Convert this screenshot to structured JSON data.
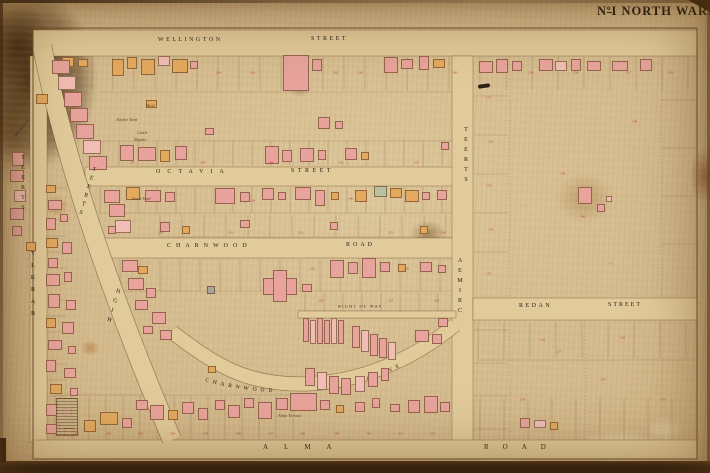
{
  "title": {
    "no": "N",
    "sup": "o",
    "rest": "I NORTH WARD"
  },
  "grove_label": {
    "part1": "CHARNWOOD",
    "part2": "GROVE"
  },
  "palette": {
    "building_pink": "#e8a49c",
    "building_pink_light": "#f0beb4",
    "building_orange": "#e3a95f",
    "building_green": "#b9c1a3",
    "building_grey": "#aaa596",
    "street_fill": "#e2cb9b",
    "paper": "#d3b98c",
    "lot_number_red": "#b5473e",
    "ink": "#2a2016"
  },
  "street_labels": [
    {
      "t": "WELLINGTON",
      "x": 158,
      "y": 37,
      "fs": 6,
      "ls": 2.5,
      "cls": "h"
    },
    {
      "t": "STREET",
      "x": 311,
      "y": 36,
      "fs": 6,
      "ls": 2.5,
      "cls": "h"
    },
    {
      "t": "OCTAVIA",
      "x": 156,
      "y": 169,
      "fs": 6,
      "ls": 7,
      "cls": "h"
    },
    {
      "t": "STREET",
      "x": 291,
      "y": 168,
      "fs": 6,
      "ls": 3.5,
      "cls": "h"
    },
    {
      "t": "CHARNWOOD",
      "x": 167,
      "y": 243,
      "fs": 6,
      "ls": 5,
      "cls": "h"
    },
    {
      "t": "ROAD",
      "x": 346,
      "y": 242,
      "fs": 6,
      "ls": 3,
      "cls": "h"
    },
    {
      "t": "REDAN",
      "x": 519,
      "y": 303,
      "fs": 6,
      "ls": 2.5,
      "cls": "h"
    },
    {
      "t": "STREET",
      "x": 608,
      "y": 302,
      "fs": 6,
      "ls": 2,
      "cls": "h"
    },
    {
      "t": "ALMA",
      "x": 263,
      "y": 444,
      "fs": 7,
      "ls": 16,
      "cls": "h"
    },
    {
      "t": "ROAD",
      "x": 484,
      "y": 444,
      "fs": 7,
      "ls": 14,
      "cls": "h"
    },
    {
      "t": "RIGHT OF WAY",
      "x": 338,
      "y": 305,
      "fs": 6,
      "ls": 2,
      "cls": "h",
      "sc": 0.68
    },
    {
      "t": "NELSON ST",
      "x": 14,
      "y": 136,
      "fs": 6,
      "ls": 0.5,
      "cls": "h",
      "rot": -52,
      "sc": 0.6
    },
    {
      "t": "BARKLY",
      "x": 33,
      "y": 287,
      "fs": 6,
      "ls": 6,
      "cls": "v",
      "up": true
    },
    {
      "t": "STREET",
      "x": 23,
      "y": 185,
      "fs": 6,
      "ls": 4,
      "cls": "v",
      "up": true
    },
    {
      "t": "CRIMEA",
      "x": 460,
      "y": 288,
      "fs": 6,
      "ls": 4,
      "cls": "v",
      "up": true
    },
    {
      "t": "STREET",
      "x": 466,
      "y": 157,
      "fs": 6,
      "ls": 4,
      "cls": "v",
      "up": true
    },
    {
      "t": "HIGH",
      "x": 113,
      "y": 308,
      "fs": 6,
      "ls": 4,
      "cls": "v",
      "up": true,
      "rot": 17
    },
    {
      "t": "STREET",
      "x": 87,
      "y": 193,
      "fs": 6,
      "ls": 3,
      "cls": "v",
      "up": true,
      "rot": 17
    }
  ],
  "cursive_labels": [
    {
      "t": "Shed",
      "x": 146,
      "y": 104
    },
    {
      "t": "Timber Yard",
      "x": 116,
      "y": 118
    },
    {
      "t": "Cattle",
      "x": 137,
      "y": 131
    },
    {
      "t": "Market",
      "x": 134,
      "y": 138
    },
    {
      "t": "Stock Yard",
      "x": 132,
      "y": 197
    },
    {
      "t": "Alma Terrace",
      "x": 278,
      "y": 414
    }
  ],
  "lot_numbers": [
    {
      "t": "264",
      "x": 216,
      "y": 71
    },
    {
      "t": "263",
      "x": 250,
      "y": 71
    },
    {
      "t": "262",
      "x": 333,
      "y": 71
    },
    {
      "t": "261",
      "x": 358,
      "y": 71
    },
    {
      "t": "260",
      "x": 452,
      "y": 71
    },
    {
      "t": "259",
      "x": 528,
      "y": 71
    },
    {
      "t": "258",
      "x": 573,
      "y": 71
    },
    {
      "t": "257",
      "x": 626,
      "y": 71
    },
    {
      "t": "256",
      "x": 668,
      "y": 71
    },
    {
      "t": "151",
      "x": 486,
      "y": 96
    },
    {
      "t": "152",
      "x": 488,
      "y": 140
    },
    {
      "t": "153",
      "x": 486,
      "y": 184
    },
    {
      "t": "154",
      "x": 488,
      "y": 228
    },
    {
      "t": "155",
      "x": 486,
      "y": 272
    },
    {
      "t": "150",
      "x": 560,
      "y": 172
    },
    {
      "t": "149",
      "x": 632,
      "y": 120
    },
    {
      "t": "166",
      "x": 580,
      "y": 215
    },
    {
      "t": "171",
      "x": 608,
      "y": 262
    },
    {
      "t": "247",
      "x": 130,
      "y": 161
    },
    {
      "t": "248",
      "x": 200,
      "y": 161
    },
    {
      "t": "249",
      "x": 268,
      "y": 161
    },
    {
      "t": "250",
      "x": 338,
      "y": 161
    },
    {
      "t": "251",
      "x": 414,
      "y": 161
    },
    {
      "t": "239",
      "x": 250,
      "y": 199
    },
    {
      "t": "240",
      "x": 348,
      "y": 197
    },
    {
      "t": "230",
      "x": 158,
      "y": 231
    },
    {
      "t": "231",
      "x": 228,
      "y": 231
    },
    {
      "t": "232",
      "x": 298,
      "y": 231
    },
    {
      "t": "233",
      "x": 388,
      "y": 231
    },
    {
      "t": "234",
      "x": 440,
      "y": 231
    },
    {
      "t": "225",
      "x": 310,
      "y": 267
    },
    {
      "t": "226",
      "x": 404,
      "y": 267
    },
    {
      "t": "218",
      "x": 318,
      "y": 299
    },
    {
      "t": "219",
      "x": 388,
      "y": 299
    },
    {
      "t": "220",
      "x": 434,
      "y": 299
    },
    {
      "t": "301",
      "x": 74,
      "y": 432
    },
    {
      "t": "302",
      "x": 106,
      "y": 432
    },
    {
      "t": "303",
      "x": 138,
      "y": 432
    },
    {
      "t": "304",
      "x": 170,
      "y": 432
    },
    {
      "t": "305",
      "x": 203,
      "y": 432
    },
    {
      "t": "306",
      "x": 236,
      "y": 432
    },
    {
      "t": "307",
      "x": 268,
      "y": 432
    },
    {
      "t": "308",
      "x": 300,
      "y": 432
    },
    {
      "t": "309",
      "x": 334,
      "y": 432
    },
    {
      "t": "310",
      "x": 366,
      "y": 432
    },
    {
      "t": "311",
      "x": 398,
      "y": 432
    },
    {
      "t": "312",
      "x": 430,
      "y": 432
    },
    {
      "t": "156",
      "x": 520,
      "y": 398
    },
    {
      "t": "157",
      "x": 556,
      "y": 350
    },
    {
      "t": "158",
      "x": 600,
      "y": 378
    },
    {
      "t": "159",
      "x": 660,
      "y": 398
    },
    {
      "t": "161",
      "x": 540,
      "y": 338
    },
    {
      "t": "162",
      "x": 620,
      "y": 336
    }
  ],
  "buildings": [
    [
      36,
      94,
      12,
      10,
      "o"
    ],
    [
      62,
      57,
      12,
      10,
      "o"
    ],
    [
      78,
      59,
      10,
      8,
      "o"
    ],
    [
      112,
      59,
      12,
      17,
      "o"
    ],
    [
      127,
      57,
      10,
      12,
      "o"
    ],
    [
      141,
      59,
      14,
      16,
      "o"
    ],
    [
      158,
      56,
      12,
      10,
      "P"
    ],
    [
      172,
      59,
      16,
      14,
      "o"
    ],
    [
      190,
      61,
      8,
      8,
      "p"
    ],
    [
      283,
      55,
      26,
      36,
      "p"
    ],
    [
      312,
      59,
      10,
      12,
      "p"
    ],
    [
      384,
      57,
      14,
      16,
      "p"
    ],
    [
      401,
      59,
      12,
      10,
      "p"
    ],
    [
      419,
      56,
      10,
      14,
      "p"
    ],
    [
      433,
      59,
      12,
      9,
      "o"
    ],
    [
      479,
      61,
      14,
      12,
      "p"
    ],
    [
      496,
      59,
      12,
      14,
      "p"
    ],
    [
      512,
      61,
      10,
      10,
      "p"
    ],
    [
      539,
      59,
      14,
      12,
      "p"
    ],
    [
      555,
      61,
      12,
      10,
      "P"
    ],
    [
      571,
      59,
      10,
      12,
      "p"
    ],
    [
      587,
      61,
      14,
      10,
      "p"
    ],
    [
      612,
      61,
      16,
      10,
      "p"
    ],
    [
      640,
      59,
      12,
      12,
      "p"
    ],
    [
      146,
      100,
      11,
      8,
      "o"
    ],
    [
      318,
      117,
      12,
      12,
      "p"
    ],
    [
      335,
      121,
      8,
      8,
      "p"
    ],
    [
      205,
      128,
      9,
      7,
      "p"
    ],
    [
      52,
      60,
      18,
      14,
      "p"
    ],
    [
      58,
      76,
      18,
      14,
      "P"
    ],
    [
      64,
      92,
      18,
      15,
      "p"
    ],
    [
      70,
      108,
      18,
      14,
      "p"
    ],
    [
      76,
      124,
      18,
      15,
      "p"
    ],
    [
      83,
      140,
      18,
      14,
      "P"
    ],
    [
      89,
      156,
      18,
      14,
      "p"
    ],
    [
      104,
      190,
      16,
      13,
      "p"
    ],
    [
      109,
      204,
      16,
      13,
      "p"
    ],
    [
      115,
      220,
      16,
      13,
      "P"
    ],
    [
      12,
      152,
      12,
      14,
      "p"
    ],
    [
      10,
      170,
      14,
      12,
      "p"
    ],
    [
      14,
      190,
      12,
      12,
      "P"
    ],
    [
      10,
      208,
      14,
      12,
      "p"
    ],
    [
      12,
      226,
      10,
      10,
      "p"
    ],
    [
      26,
      242,
      10,
      9,
      "o"
    ],
    [
      46,
      185,
      10,
      8,
      "o"
    ],
    [
      48,
      200,
      14,
      10,
      "p"
    ],
    [
      46,
      218,
      10,
      12,
      "p"
    ],
    [
      60,
      214,
      8,
      8,
      "p"
    ],
    [
      46,
      238,
      12,
      10,
      "o"
    ],
    [
      62,
      242,
      10,
      12,
      "p"
    ],
    [
      48,
      258,
      10,
      10,
      "p"
    ],
    [
      46,
      274,
      14,
      12,
      "p"
    ],
    [
      64,
      272,
      8,
      10,
      "p"
    ],
    [
      48,
      294,
      12,
      14,
      "p"
    ],
    [
      66,
      300,
      10,
      10,
      "p"
    ],
    [
      46,
      318,
      10,
      10,
      "o"
    ],
    [
      62,
      322,
      12,
      12,
      "p"
    ],
    [
      48,
      340,
      14,
      10,
      "p"
    ],
    [
      68,
      346,
      8,
      8,
      "p"
    ],
    [
      46,
      360,
      10,
      12,
      "p"
    ],
    [
      64,
      368,
      12,
      10,
      "p"
    ],
    [
      50,
      384,
      12,
      10,
      "o"
    ],
    [
      70,
      388,
      8,
      8,
      "p"
    ],
    [
      46,
      404,
      12,
      12,
      "p"
    ],
    [
      62,
      408,
      10,
      8,
      "p"
    ],
    [
      46,
      424,
      14,
      10,
      "p"
    ],
    [
      64,
      428,
      10,
      8,
      "o"
    ],
    [
      120,
      145,
      14,
      16,
      "p"
    ],
    [
      138,
      147,
      18,
      14,
      "p"
    ],
    [
      160,
      150,
      10,
      12,
      "o"
    ],
    [
      175,
      146,
      12,
      14,
      "p"
    ],
    [
      265,
      146,
      14,
      18,
      "p"
    ],
    [
      282,
      150,
      10,
      12,
      "p"
    ],
    [
      300,
      148,
      14,
      14,
      "p"
    ],
    [
      318,
      150,
      8,
      10,
      "p"
    ],
    [
      345,
      148,
      12,
      12,
      "p"
    ],
    [
      361,
      152,
      8,
      8,
      "o"
    ],
    [
      126,
      187,
      14,
      13,
      "o"
    ],
    [
      145,
      190,
      16,
      12,
      "p"
    ],
    [
      165,
      192,
      10,
      10,
      "p"
    ],
    [
      215,
      188,
      20,
      16,
      "p"
    ],
    [
      240,
      192,
      10,
      10,
      "p"
    ],
    [
      262,
      188,
      12,
      12,
      "p"
    ],
    [
      278,
      192,
      8,
      8,
      "p"
    ],
    [
      295,
      187,
      16,
      13,
      "p"
    ],
    [
      315,
      190,
      10,
      16,
      "p"
    ],
    [
      331,
      192,
      8,
      8,
      "o"
    ],
    [
      355,
      190,
      12,
      12,
      "o"
    ],
    [
      374,
      186,
      13,
      11,
      "gn"
    ],
    [
      390,
      188,
      12,
      10,
      "o"
    ],
    [
      405,
      190,
      14,
      12,
      "o"
    ],
    [
      422,
      192,
      8,
      8,
      "p"
    ],
    [
      437,
      190,
      10,
      10,
      "p"
    ],
    [
      160,
      222,
      10,
      10,
      "p"
    ],
    [
      182,
      226,
      8,
      8,
      "o"
    ],
    [
      240,
      220,
      10,
      8,
      "p"
    ],
    [
      330,
      222,
      8,
      8,
      "p"
    ],
    [
      420,
      226,
      8,
      8,
      "o"
    ],
    [
      108,
      226,
      8,
      8,
      "p"
    ],
    [
      207,
      286,
      8,
      8,
      "g"
    ],
    [
      441,
      142,
      8,
      8,
      "p"
    ],
    [
      122,
      260,
      16,
      12,
      "p"
    ],
    [
      138,
      266,
      10,
      8,
      "o"
    ],
    [
      128,
      278,
      16,
      12,
      "p"
    ],
    [
      146,
      288,
      10,
      10,
      "p"
    ],
    [
      135,
      300,
      13,
      10,
      "p"
    ],
    [
      152,
      312,
      14,
      12,
      "p"
    ],
    [
      143,
      326,
      10,
      8,
      "p"
    ],
    [
      160,
      330,
      12,
      10,
      "p"
    ],
    [
      330,
      260,
      14,
      18,
      "p"
    ],
    [
      348,
      262,
      10,
      12,
      "p"
    ],
    [
      362,
      258,
      14,
      20,
      "p"
    ],
    [
      380,
      262,
      10,
      10,
      "p"
    ],
    [
      398,
      264,
      8,
      8,
      "o"
    ],
    [
      420,
      262,
      12,
      10,
      "p"
    ],
    [
      438,
      265,
      8,
      8,
      "p"
    ],
    [
      302,
      284,
      10,
      8,
      "p"
    ],
    [
      263,
      278,
      34,
      17,
      "p"
    ],
    [
      273,
      270,
      14,
      32,
      "p"
    ],
    [
      303,
      318,
      6,
      24,
      "p"
    ],
    [
      310,
      320,
      6,
      24,
      "P"
    ],
    [
      317,
      318,
      6,
      26,
      "p"
    ],
    [
      324,
      320,
      6,
      24,
      "p"
    ],
    [
      331,
      318,
      6,
      26,
      "P"
    ],
    [
      338,
      320,
      6,
      24,
      "p"
    ],
    [
      352,
      326,
      8,
      22,
      "p"
    ],
    [
      361,
      330,
      8,
      22,
      "P"
    ],
    [
      370,
      334,
      8,
      22,
      "p"
    ],
    [
      379,
      338,
      8,
      20,
      "p"
    ],
    [
      388,
      342,
      8,
      18,
      "P"
    ],
    [
      415,
      330,
      14,
      12,
      "p"
    ],
    [
      432,
      334,
      10,
      10,
      "p"
    ],
    [
      438,
      318,
      10,
      9,
      "p"
    ],
    [
      305,
      368,
      10,
      18,
      "p"
    ],
    [
      317,
      372,
      10,
      18,
      "P"
    ],
    [
      329,
      376,
      10,
      18,
      "p"
    ],
    [
      341,
      378,
      10,
      17,
      "p"
    ],
    [
      355,
      376,
      10,
      16,
      "P"
    ],
    [
      368,
      372,
      10,
      15,
      "p"
    ],
    [
      381,
      368,
      8,
      13,
      "p"
    ],
    [
      208,
      366,
      8,
      7,
      "o"
    ],
    [
      56,
      398,
      22,
      38,
      "h"
    ],
    [
      84,
      420,
      12,
      12,
      "o"
    ],
    [
      100,
      412,
      18,
      13,
      "o"
    ],
    [
      122,
      418,
      10,
      10,
      "p"
    ],
    [
      136,
      400,
      12,
      10,
      "p"
    ],
    [
      150,
      405,
      14,
      15,
      "p"
    ],
    [
      168,
      410,
      10,
      10,
      "o"
    ],
    [
      182,
      402,
      12,
      12,
      "p"
    ],
    [
      198,
      408,
      10,
      12,
      "p"
    ],
    [
      215,
      400,
      10,
      10,
      "p"
    ],
    [
      228,
      405,
      12,
      13,
      "p"
    ],
    [
      244,
      398,
      10,
      10,
      "p"
    ],
    [
      258,
      402,
      14,
      17,
      "p"
    ],
    [
      276,
      398,
      12,
      12,
      "p"
    ],
    [
      290,
      393,
      27,
      18,
      "p"
    ],
    [
      320,
      400,
      10,
      10,
      "p"
    ],
    [
      336,
      405,
      8,
      8,
      "o"
    ],
    [
      355,
      402,
      10,
      10,
      "p"
    ],
    [
      372,
      398,
      8,
      10,
      "p"
    ],
    [
      390,
      404,
      10,
      8,
      "p"
    ],
    [
      408,
      400,
      12,
      13,
      "p"
    ],
    [
      424,
      396,
      14,
      17,
      "p"
    ],
    [
      440,
      402,
      10,
      10,
      "p"
    ],
    [
      520,
      418,
      10,
      10,
      "p"
    ],
    [
      534,
      420,
      12,
      8,
      "P"
    ],
    [
      550,
      422,
      8,
      8,
      "o"
    ],
    [
      578,
      187,
      14,
      17,
      "p"
    ],
    [
      597,
      204,
      8,
      8,
      "p"
    ],
    [
      606,
      196,
      6,
      6,
      "P"
    ]
  ]
}
